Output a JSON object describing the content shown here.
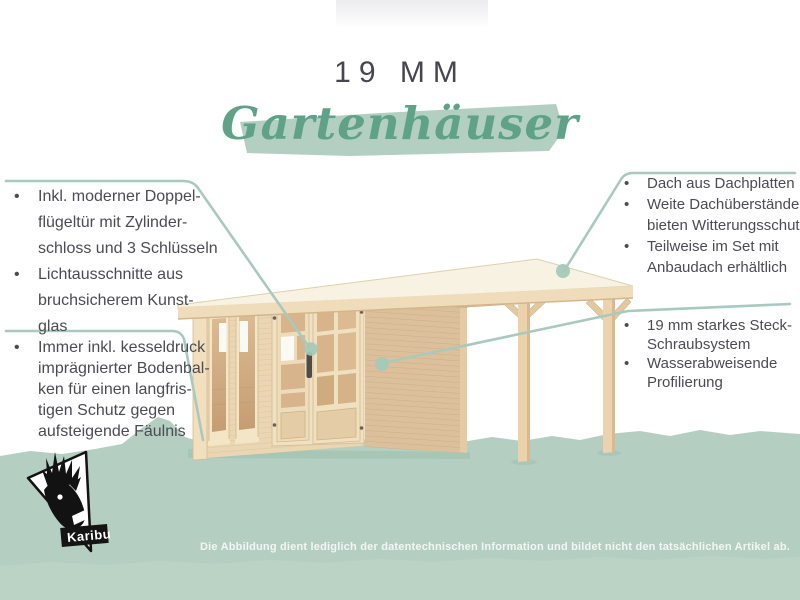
{
  "header": {
    "size_label": "19 MM",
    "title_script": "Gartenhäuser"
  },
  "callouts": {
    "left_top": {
      "items": [
        {
          "lines": [
            "Inkl. moderner Doppel-",
            "flügeltür mit Zylinder-",
            "schloss und 3 Schlüsseln"
          ]
        },
        {
          "lines": [
            "Lichtausschnitte aus",
            "bruchsicherem Kunst-",
            "glas"
          ]
        }
      ]
    },
    "left_bottom": {
      "items": [
        {
          "lines": [
            "Immer inkl. kesseldruck",
            "imprägnierter Bodenbal-",
            "ken für einen langfris-",
            "tigen Schutz gegen",
            "aufsteigende Fäulnis"
          ]
        }
      ]
    },
    "right_top": {
      "items": [
        {
          "lines": [
            "Dach aus Dachplatten"
          ]
        },
        {
          "lines": [
            "Weite Dachüberstände",
            "bieten Witterungsschutz"
          ]
        },
        {
          "lines": [
            "Teilweise im Set mit",
            "Anbaudach erhältlich"
          ]
        }
      ]
    },
    "right_bottom": {
      "items": [
        {
          "lines": [
            "19 mm starkes Steck-",
            "Schraubsystem"
          ]
        },
        {
          "lines": [
            "Wasserabweisende",
            "Profilierung"
          ]
        }
      ]
    },
    "bullet_glyph": "•"
  },
  "logo": {
    "brand": "Karibu"
  },
  "footer": {
    "disclaimer": "Die Abbildung dient lediglich der datentechnischen Information und bildet nicht den tatsächlichen Artikel ab."
  },
  "colors": {
    "accent_green": "#5fa287",
    "brush_green": "#b2cfc1",
    "ground_green": "#b4cfc1",
    "line_teal": "#a8cabd",
    "text_gray": "#4b4b52",
    "wood_light": "#ead6b2",
    "wood_mid": "#dcc09b"
  }
}
